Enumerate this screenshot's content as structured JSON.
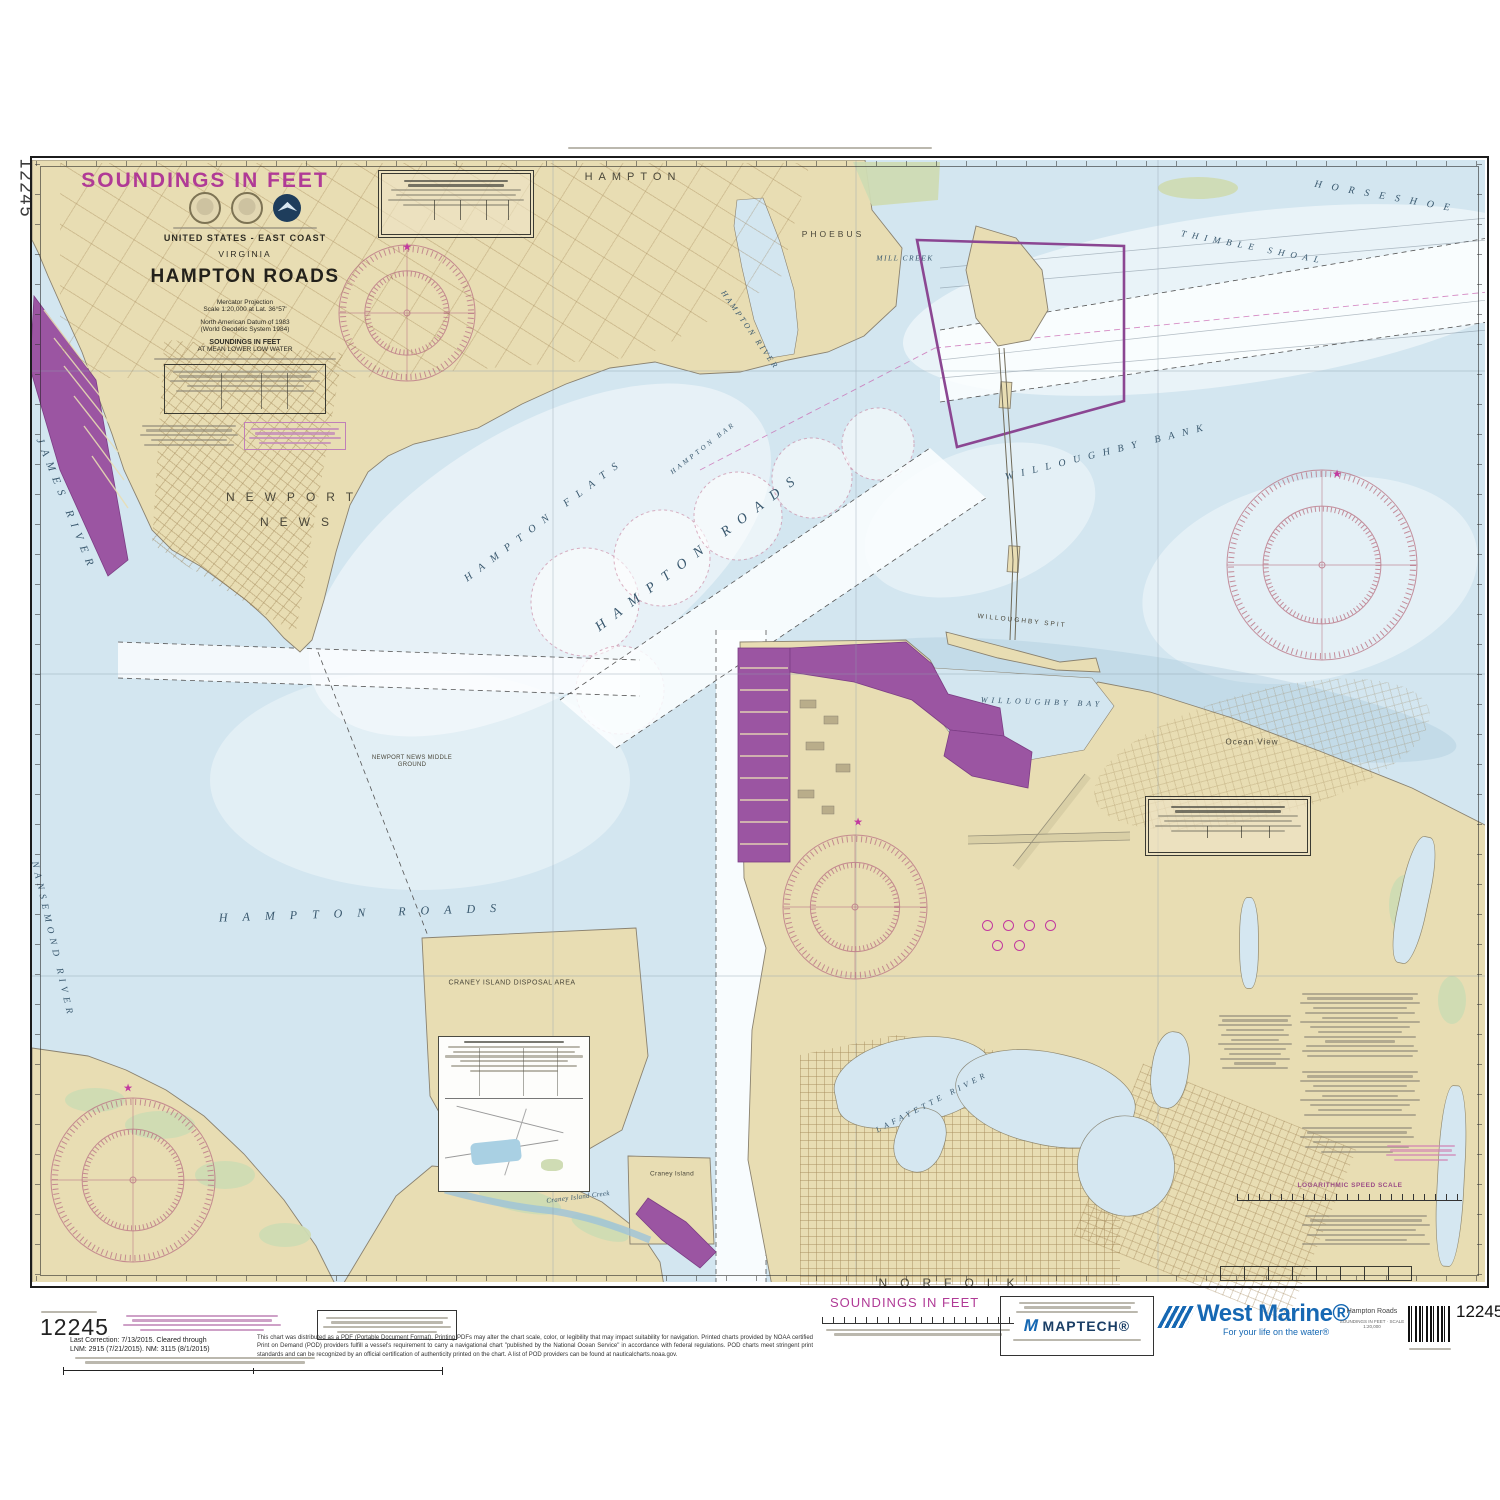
{
  "chart_number": "12245",
  "edge": {
    "vertical_chart_number": "12245"
  },
  "title_block": {
    "region": "UNITED STATES - EAST COAST",
    "state": "VIRGINIA",
    "title": "HAMPTON ROADS",
    "projection": "Mercator Projection",
    "scale": "Scale 1:20,000 at Lat. 36°57'",
    "datum_1": "North American Datum of 1983",
    "datum_2": "(World Geodetic System 1984)",
    "soundings_1": "SOUNDINGS IN FEET",
    "soundings_2": "AT MEAN LOWER LOW WATER"
  },
  "notes": {
    "log_speed_scale": "LOGARITHMIC SPEED SCALE"
  },
  "map_labels": [
    {
      "id": "soundings-note-topleft",
      "text": "SOUNDINGS IN FEET",
      "x": 205,
      "y": 181,
      "fs": 21,
      "ls": 2,
      "color": "#b03a96",
      "bold": 1
    },
    {
      "id": "label-hampton",
      "text": "HAMPTON",
      "x": 633,
      "y": 177,
      "fs": 11,
      "ls": 6,
      "color": "#4a473a"
    },
    {
      "id": "label-phoebus",
      "text": "PHOEBUS",
      "x": 833,
      "y": 234,
      "fs": 8.5,
      "ls": 3,
      "color": "#4a473a"
    },
    {
      "id": "label-mill-creek",
      "text": "MILL CREEK",
      "x": 905,
      "y": 258,
      "fs": 7.5,
      "ls": 1.5,
      "color": "#39586e",
      "italic": 1,
      "serif": 1
    },
    {
      "id": "label-hampton-river",
      "text": "HAMPTON RIVER",
      "x": 750,
      "y": 330,
      "fs": 8,
      "ls": 2.5,
      "rot": 55,
      "color": "#39586e",
      "italic": 1,
      "serif": 1
    },
    {
      "id": "label-james-river",
      "text": "JAMES RIVER",
      "x": 66,
      "y": 505,
      "fs": 11,
      "ls": 7,
      "rot": 68,
      "color": "#39586e",
      "italic": 1,
      "serif": 1
    },
    {
      "id": "label-newport",
      "text": "NEWPORT",
      "x": 295,
      "y": 497,
      "fs": 12,
      "ls": 11,
      "color": "#4a473a"
    },
    {
      "id": "label-news",
      "text": "NEWS",
      "x": 300,
      "y": 522,
      "fs": 12,
      "ls": 11,
      "color": "#4a473a"
    },
    {
      "id": "label-hampton-flats",
      "text": "HAMPTON FLATS",
      "x": 545,
      "y": 520,
      "fs": 10.5,
      "ls": 9,
      "rot": -37,
      "color": "#39586e",
      "italic": 1,
      "serif": 1
    },
    {
      "id": "label-hampton-bar",
      "text": "HAMPTON BAR",
      "x": 703,
      "y": 448,
      "fs": 7,
      "ls": 3,
      "rot": -38,
      "color": "#39586e",
      "italic": 1,
      "serif": 1
    },
    {
      "id": "label-hampton-roads-upper",
      "text": "HAMPTON ROADS",
      "x": 700,
      "y": 552,
      "fs": 14,
      "ls": 11,
      "rot": -37,
      "color": "#39586e",
      "italic": 1,
      "serif": 1
    },
    {
      "id": "label-willoughby-bank",
      "text": "WILLOUGHBY BANK",
      "x": 1108,
      "y": 452,
      "fs": 10,
      "ls": 8,
      "rot": -14,
      "color": "#39586e",
      "italic": 1,
      "serif": 1
    },
    {
      "id": "label-willoughby-spit",
      "text": "WILLOUGHBY SPIT",
      "x": 1022,
      "y": 621,
      "fs": 6.5,
      "ls": 2,
      "rot": 6,
      "color": "#4a473a"
    },
    {
      "id": "label-willoughby-bay",
      "text": "WILLOUGHBY BAY",
      "x": 1042,
      "y": 702,
      "fs": 8,
      "ls": 4,
      "rot": 2,
      "color": "#39586e",
      "italic": 1,
      "serif": 1
    },
    {
      "id": "label-ocean-view",
      "text": "Ocean View",
      "x": 1252,
      "y": 742,
      "fs": 8,
      "ls": 1,
      "color": "#4a473a"
    },
    {
      "id": "label-thimble-shoal",
      "text": "THIMBLE SHOAL",
      "x": 1253,
      "y": 247,
      "fs": 9,
      "ls": 6,
      "rot": 11,
      "color": "#39586e",
      "italic": 1,
      "serif": 1
    },
    {
      "id": "label-horseshoe",
      "text": "HORSESHOE",
      "x": 1387,
      "y": 197,
      "fs": 10,
      "ls": 10,
      "rot": 10,
      "color": "#39586e",
      "italic": 1,
      "serif": 1
    },
    {
      "id": "label-nansemond-river",
      "text": "NANSEMOND RIVER",
      "x": 52,
      "y": 940,
      "fs": 9.5,
      "ls": 5,
      "rot": 77,
      "color": "#39586e",
      "italic": 1,
      "serif": 1
    },
    {
      "id": "label-hampton-roads-lower",
      "text": "HAMPTON ROADS",
      "x": 365,
      "y": 913,
      "fs": 12,
      "ls": 15,
      "rot": -2,
      "color": "#39586e",
      "italic": 1,
      "serif": 1
    },
    {
      "id": "label-craney-disposal",
      "text": "CRANEY ISLAND DISPOSAL AREA",
      "x": 512,
      "y": 983,
      "fs": 7,
      "ls": 0.5,
      "color": "#4a473a"
    },
    {
      "id": "label-craney-island",
      "text": "Craney Island",
      "x": 672,
      "y": 1174,
      "fs": 6.5,
      "ls": 0.3,
      "color": "#4a473a"
    },
    {
      "id": "label-craney-creek",
      "text": "Craney Island Creek",
      "x": 578,
      "y": 1197,
      "fs": 7,
      "ls": 0.3,
      "rot": -7,
      "color": "#39586e",
      "italic": 1,
      "serif": 1
    },
    {
      "id": "label-norfolk",
      "text": "NORFOLK",
      "x": 953,
      "y": 1283,
      "fs": 12,
      "ls": 13,
      "color": "#4a473a"
    },
    {
      "id": "label-lafayette-river",
      "text": "LAFAYETTE RIVER",
      "x": 932,
      "y": 1102,
      "fs": 8,
      "ls": 4,
      "rot": -27,
      "color": "#39586e",
      "italic": 1,
      "serif": 1
    },
    {
      "id": "label-nn-middle-ground",
      "text": "NEWPORT NEWS MIDDLE GROUND",
      "x": 412,
      "y": 762,
      "fs": 6,
      "ls": 0.3,
      "color": "#4a473a",
      "w": 86
    },
    {
      "id": "star-icon-1",
      "text": "★",
      "x": 407,
      "y": 247,
      "fs": 11,
      "color": "#c2399f"
    },
    {
      "id": "star-icon-2",
      "text": "★",
      "x": 1337,
      "y": 474,
      "fs": 11,
      "color": "#c2399f"
    },
    {
      "id": "star-icon-3",
      "text": "★",
      "x": 858,
      "y": 822,
      "fs": 11,
      "color": "#c2399f"
    },
    {
      "id": "star-icon-4",
      "text": "★",
      "x": 128,
      "y": 1088,
      "fs": 11,
      "color": "#c2399f"
    }
  ],
  "footer": {
    "chart_number_left": "12245",
    "chart_number_right": "12245",
    "correction_line_1": "Last Correction: 7/13/2015.  Cleared through",
    "correction_line_2": "LNM: 2915 (7/21/2015). NM: 3115 (8/1/2015)",
    "soundings_label": "SOUNDINGS IN FEET",
    "pod_note": "This chart was distributed as a PDF (Portable Document Format). Printing PDFs may alter the chart scale, color, or legibility that may impact suitability for navigation. Printed charts provided by NOAA certified Print on Demand (POD) providers fulfill a vessel's requirement to carry a navigational chart \"published by the National Ocean Service\" in accordance with federal regulations. POD charts meet stringent print standards and can be recognized by an official certification of authenticity printed on the chart. A list of POD providers can be found at nauticalcharts.noaa.gov.",
    "maptech_name": "MAPTECH®",
    "west_marine_name": "West Marine®",
    "west_marine_tagline": "For your life on the water®",
    "product_title": "Hampton Roads",
    "product_subtitle": "SOUNDINGS IN FEET · SCALE 1:20,000"
  }
}
